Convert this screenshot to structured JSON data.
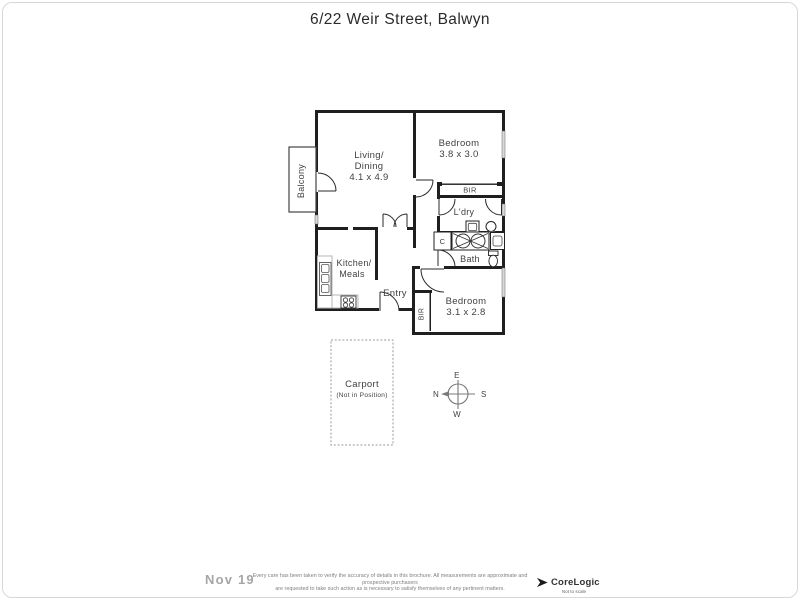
{
  "page": {
    "title": "6/22 Weir Street, Balwyn"
  },
  "rooms": {
    "living": {
      "line1": "Living/",
      "line2": "Dining",
      "dims": "4.1 x 4.9"
    },
    "bedroom1": {
      "line1": "Bedroom",
      "dims": "3.8 x 3.0"
    },
    "bedroom2": {
      "line1": "Bedroom",
      "dims": "3.1 x 2.8"
    },
    "kitchen": {
      "line1": "Kitchen/",
      "line2": "Meals"
    },
    "balcony": {
      "label": "Balcony"
    },
    "entry": {
      "label": "Entry"
    },
    "laundry": {
      "label": "L'dry"
    },
    "bath": {
      "label": "Bath"
    },
    "cupboard": {
      "label": "C"
    },
    "bir_bed1": {
      "label": "BIR"
    },
    "bir_bed2": {
      "label": "BIR"
    }
  },
  "carport": {
    "label": "Carport",
    "note": "(Not in Position)"
  },
  "compass": {
    "n": "N",
    "e": "E",
    "s": "S",
    "w": "W"
  },
  "footer": {
    "watermark_date": "Nov 19",
    "disclaimer_line1": "Every care has been taken to verify the accuracy of details in this brochure.  All measurements are approximate and prospective purchasers",
    "disclaimer_line2": "are requested to take such action as is necessary to satisfy themselves of any pertinent matters.",
    "brand": "CoreLogic",
    "scale_note": "Not to scale"
  },
  "colors": {
    "wall": "#1f1f1f",
    "window": "#d8d8d8",
    "muted": "#7a7a7a"
  }
}
